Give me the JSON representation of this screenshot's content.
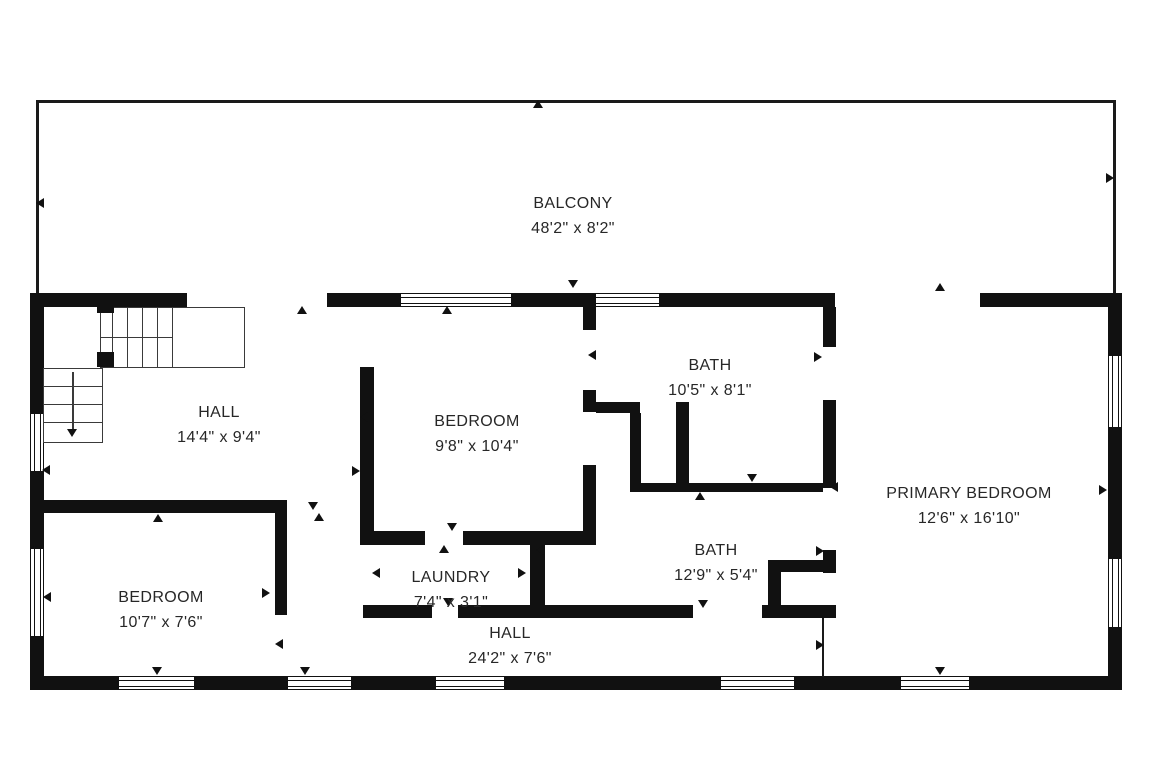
{
  "canvas": {
    "width": 1152,
    "height": 768,
    "background": "#ffffff",
    "wall_color": "#111111",
    "text_color": "#272727"
  },
  "rooms": [
    {
      "name": "BALCONY",
      "dims": "48'2\" x 8'2\"",
      "cx": 573,
      "cy": 216
    },
    {
      "name": "HALL",
      "dims": "14'4\" x 9'4\"",
      "cx": 219,
      "cy": 425
    },
    {
      "name": "BEDROOM",
      "dims": "9'8\" x 10'4\"",
      "cx": 477,
      "cy": 434
    },
    {
      "name": "BATH",
      "dims": "10'5\" x 8'1\"",
      "cx": 710,
      "cy": 378
    },
    {
      "name": "PRIMARY BEDROOM",
      "dims": "12'6\" x 16'10\"",
      "cx": 969,
      "cy": 506
    },
    {
      "name": "BEDROOM",
      "dims": "10'7\" x 7'6\"",
      "cx": 161,
      "cy": 610
    },
    {
      "name": "LAUNDRY",
      "dims": "7'4\" x 3'1\"",
      "cx": 451,
      "cy": 590
    },
    {
      "name": "BATH",
      "dims": "12'9\" x 5'4\"",
      "cx": 716,
      "cy": 563
    },
    {
      "name": "HALL",
      "dims": "24'2\" x 7'6\"",
      "cx": 510,
      "cy": 646
    }
  ],
  "walls": [
    [
      30,
      293,
      157,
      14
    ],
    [
      327,
      293,
      73,
      14
    ],
    [
      512,
      293,
      83,
      14
    ],
    [
      660,
      293,
      175,
      14
    ],
    [
      980,
      293,
      142,
      14
    ],
    [
      30,
      676,
      88,
      14
    ],
    [
      195,
      676,
      92,
      14
    ],
    [
      352,
      676,
      83,
      14
    ],
    [
      505,
      676,
      215,
      14
    ],
    [
      795,
      676,
      105,
      14
    ],
    [
      970,
      676,
      152,
      14
    ],
    [
      30,
      293,
      14,
      120
    ],
    [
      30,
      472,
      14,
      76
    ],
    [
      30,
      637,
      14,
      53
    ],
    [
      1108,
      293,
      14,
      62
    ],
    [
      1108,
      428,
      14,
      130
    ],
    [
      1108,
      628,
      14,
      62
    ],
    [
      360,
      367,
      14,
      178
    ],
    [
      583,
      307,
      13,
      23
    ],
    [
      583,
      390,
      13,
      22
    ],
    [
      583,
      465,
      13,
      70
    ],
    [
      360,
      531,
      65,
      14
    ],
    [
      463,
      531,
      133,
      14
    ],
    [
      596,
      402,
      44,
      11
    ],
    [
      630,
      413,
      11,
      79
    ],
    [
      676,
      402,
      13,
      90
    ],
    [
      630,
      483,
      193,
      9
    ],
    [
      823,
      307,
      13,
      40
    ],
    [
      823,
      400,
      13,
      88
    ],
    [
      823,
      550,
      13,
      23
    ],
    [
      823,
      608,
      13,
      10
    ],
    [
      768,
      560,
      68,
      12
    ],
    [
      768,
      560,
      13,
      58
    ],
    [
      363,
      605,
      69,
      13
    ],
    [
      458,
      605,
      235,
      13
    ],
    [
      762,
      605,
      74,
      13
    ],
    [
      530,
      531,
      15,
      87
    ],
    [
      44,
      500,
      243,
      13
    ],
    [
      275,
      500,
      12,
      115
    ]
  ],
  "thin_lines": [
    [
      36,
      100,
      2.5,
      193
    ],
    [
      36,
      100,
      1079,
      2.5
    ],
    [
      1113,
      100,
      2.5,
      193
    ],
    [
      822,
      618,
      2,
      59
    ]
  ],
  "windows": [
    {
      "x": 400,
      "y": 293,
      "w": 112,
      "h": 14,
      "dir": "h"
    },
    {
      "x": 595,
      "y": 293,
      "w": 65,
      "h": 14,
      "dir": "h"
    },
    {
      "x": 118,
      "y": 676,
      "w": 77,
      "h": 14,
      "dir": "h"
    },
    {
      "x": 287,
      "y": 676,
      "w": 65,
      "h": 14,
      "dir": "h"
    },
    {
      "x": 435,
      "y": 676,
      "w": 70,
      "h": 14,
      "dir": "h"
    },
    {
      "x": 720,
      "y": 676,
      "w": 75,
      "h": 14,
      "dir": "h"
    },
    {
      "x": 900,
      "y": 676,
      "w": 70,
      "h": 14,
      "dir": "h"
    },
    {
      "x": 30,
      "y": 413,
      "w": 14,
      "h": 59,
      "dir": "v"
    },
    {
      "x": 30,
      "y": 548,
      "w": 14,
      "h": 89,
      "dir": "v"
    },
    {
      "x": 1108,
      "y": 355,
      "w": 14,
      "h": 73,
      "dir": "v"
    },
    {
      "x": 1108,
      "y": 558,
      "w": 14,
      "h": 70,
      "dir": "v"
    }
  ],
  "markers": [
    {
      "x": 538,
      "y": 104,
      "dir": "up"
    },
    {
      "x": 40,
      "y": 203,
      "dir": "left"
    },
    {
      "x": 1110,
      "y": 178,
      "dir": "right"
    },
    {
      "x": 573,
      "y": 284,
      "dir": "down"
    },
    {
      "x": 302,
      "y": 310,
      "dir": "up"
    },
    {
      "x": 447,
      "y": 310,
      "dir": "up"
    },
    {
      "x": 940,
      "y": 287,
      "dir": "up"
    },
    {
      "x": 158,
      "y": 518,
      "dir": "up"
    },
    {
      "x": 313,
      "y": 506,
      "dir": "down"
    },
    {
      "x": 319,
      "y": 517,
      "dir": "up"
    },
    {
      "x": 46,
      "y": 470,
      "dir": "left"
    },
    {
      "x": 47,
      "y": 597,
      "dir": "left"
    },
    {
      "x": 1103,
      "y": 490,
      "dir": "right"
    },
    {
      "x": 364,
      "y": 417,
      "dir": "left"
    },
    {
      "x": 356,
      "y": 471,
      "dir": "right"
    },
    {
      "x": 592,
      "y": 355,
      "dir": "left"
    },
    {
      "x": 818,
      "y": 357,
      "dir": "right"
    },
    {
      "x": 752,
      "y": 478,
      "dir": "down"
    },
    {
      "x": 700,
      "y": 496,
      "dir": "up"
    },
    {
      "x": 834,
      "y": 487,
      "dir": "left"
    },
    {
      "x": 820,
      "y": 551,
      "dir": "right"
    },
    {
      "x": 452,
      "y": 527,
      "dir": "down"
    },
    {
      "x": 444,
      "y": 549,
      "dir": "up"
    },
    {
      "x": 448,
      "y": 602,
      "dir": "down"
    },
    {
      "x": 376,
      "y": 573,
      "dir": "left"
    },
    {
      "x": 522,
      "y": 573,
      "dir": "right"
    },
    {
      "x": 540,
      "y": 550,
      "dir": "left"
    },
    {
      "x": 703,
      "y": 604,
      "dir": "down"
    },
    {
      "x": 820,
      "y": 645,
      "dir": "right"
    },
    {
      "x": 266,
      "y": 593,
      "dir": "right"
    },
    {
      "x": 279,
      "y": 644,
      "dir": "left"
    },
    {
      "x": 157,
      "y": 671,
      "dir": "down"
    },
    {
      "x": 305,
      "y": 671,
      "dir": "down"
    },
    {
      "x": 940,
      "y": 671,
      "dir": "down"
    }
  ],
  "stairs": {
    "upper_box": [
      100,
      307,
      145,
      61
    ],
    "lower_box": [
      43,
      368,
      60,
      75
    ],
    "upper_treads_x": [
      112,
      127,
      142,
      157,
      172
    ],
    "upper_tread_top": 307,
    "upper_tread_height": 61,
    "mid_line": [
      100,
      337,
      72,
      1.4
    ],
    "lower_treads_y": [
      386,
      404,
      422
    ],
    "lower_tread_left": 43,
    "lower_tread_width": 60,
    "newels": [
      [
        97,
        301,
        17,
        12
      ],
      [
        97,
        352,
        17,
        15
      ]
    ],
    "arrow": {
      "x": 73,
      "y1": 372,
      "y2": 430
    }
  }
}
